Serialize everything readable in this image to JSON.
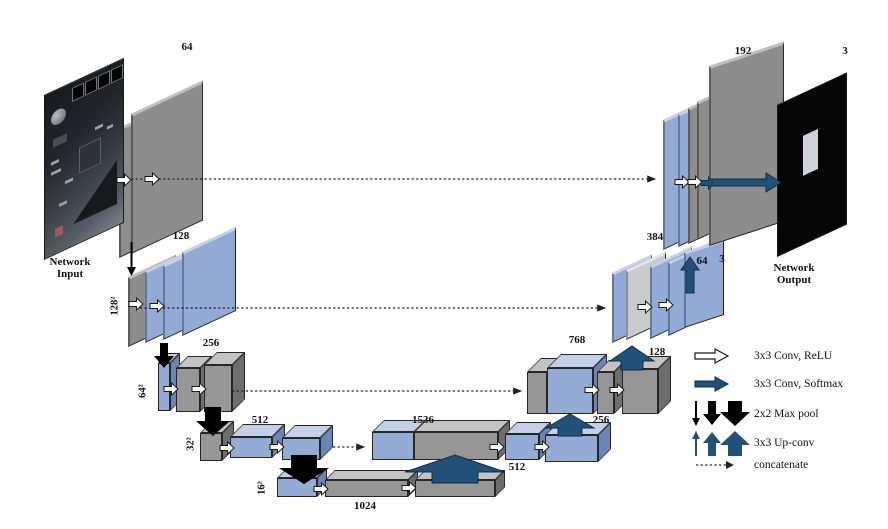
{
  "diagram": {
    "input": {
      "caption1": "Network",
      "caption2": "Input"
    },
    "output": {
      "caption1": "Network",
      "caption2": "Output",
      "channels": "3"
    },
    "encoder": {
      "e1": "64",
      "e2": "128",
      "e3": "256",
      "e4": "512",
      "e5": "1024",
      "s2": "128²",
      "s3": "64²",
      "s4": "32²",
      "s5": "16²"
    },
    "decoder": {
      "up1": "512",
      "cat1": "1536",
      "up2": "256",
      "cat2": "768",
      "up3": "128",
      "cat3": "384",
      "conv": "64",
      "aux": "3",
      "cat4": "192"
    }
  },
  "legend": {
    "items": [
      {
        "icon": "white-right-arrow-icon",
        "label": "3x3 Conv, ReLU"
      },
      {
        "icon": "navy-right-arrow-icon",
        "label": "3x3 Conv, Softmax"
      },
      {
        "icon": "black-down-arrows-icon",
        "label": "2x2 Max pool"
      },
      {
        "icon": "blue-up-arrows-icon",
        "label": "3x3 Up-conv"
      },
      {
        "icon": "dotted-arrow-icon",
        "label": "concatenate"
      }
    ]
  }
}
